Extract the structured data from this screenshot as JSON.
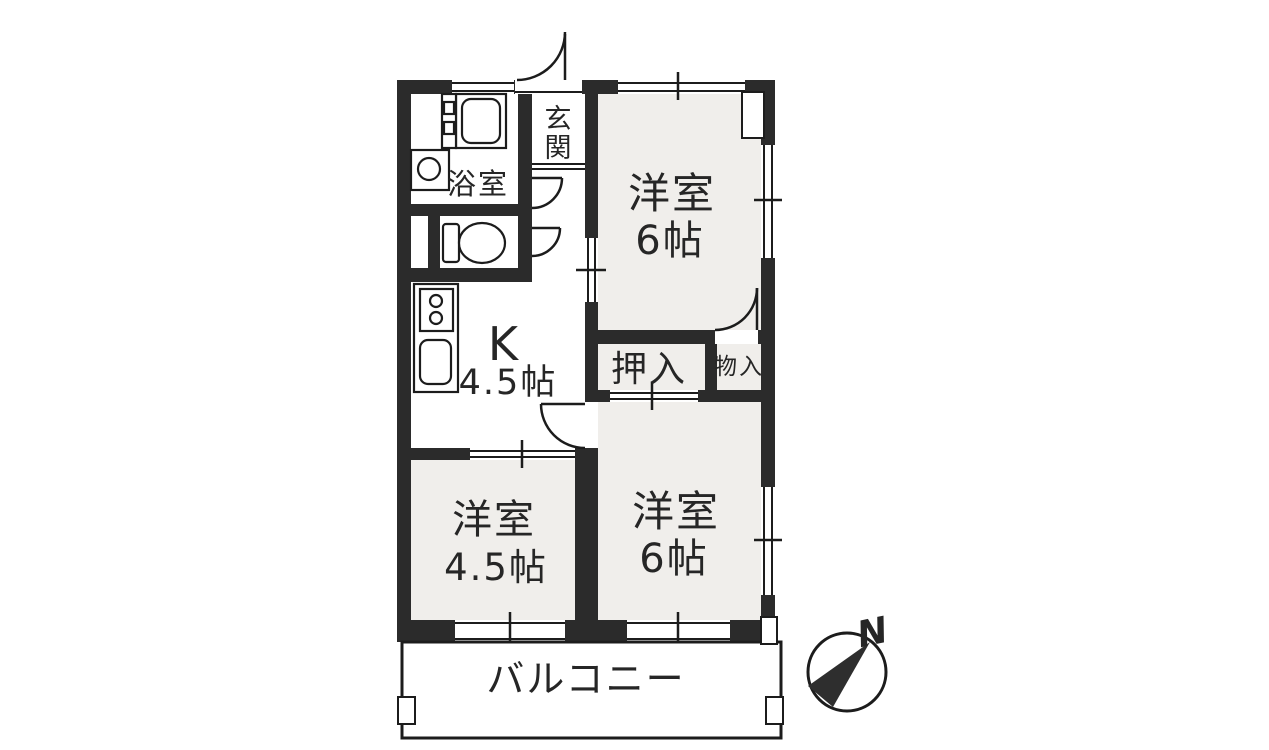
{
  "floorplan": {
    "type": "apartment-floor-plan",
    "rooms": {
      "genkan": {
        "label": "玄関",
        "char1": "玄",
        "char2": "関"
      },
      "bathroom": {
        "label": "浴室"
      },
      "kitchen": {
        "label": "K",
        "size": "4.5帖"
      },
      "room_ne": {
        "label": "洋室",
        "size": "6帖"
      },
      "room_se": {
        "label": "洋室",
        "size": "6帖"
      },
      "room_sw": {
        "label": "洋室",
        "size": "4.5帖"
      },
      "oshiire": {
        "label": "押入"
      },
      "monoire": {
        "label": "物入"
      },
      "balcony": {
        "label": "バルコニー"
      }
    },
    "compass": {
      "north_label": "N"
    },
    "colors": {
      "wall": "#2b2b2b",
      "room_fill": "#f0eeeb",
      "line": "#1c1c1c",
      "background": "#ffffff"
    }
  }
}
